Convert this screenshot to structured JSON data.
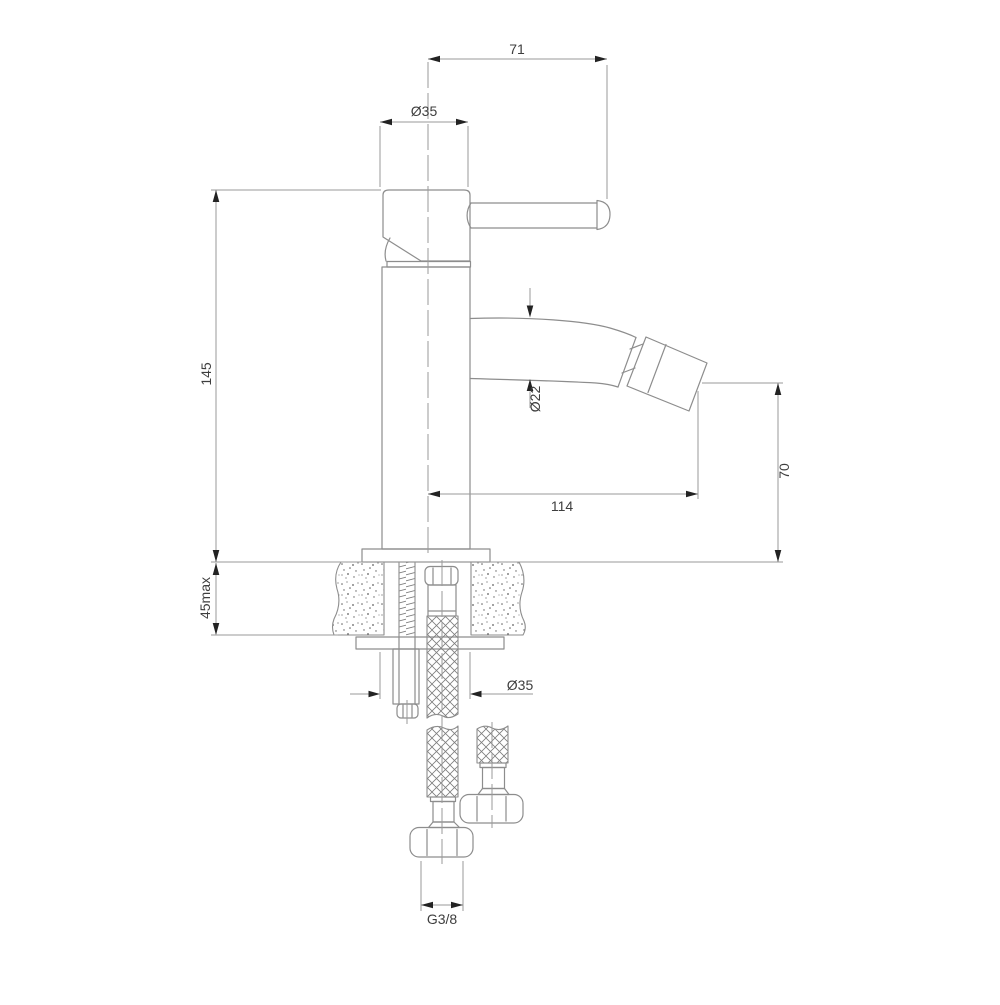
{
  "dimensions": {
    "handle_span": {
      "label": "71"
    },
    "head_diameter": {
      "label": "Ø35"
    },
    "body_height": {
      "label": "145"
    },
    "spout_diameter": {
      "label": "Ø22"
    },
    "spout_reach": {
      "label": "114"
    },
    "outlet_height": {
      "label": "70"
    },
    "deck_thickness": {
      "label": "45max"
    },
    "shank_diameter": {
      "label": "Ø35"
    },
    "connection_thread": {
      "label": "G3/8"
    }
  },
  "colors": {
    "background": "#ffffff",
    "line": "#8d8d8d",
    "dim": "#9a9a9a",
    "arrow": "#232323",
    "text": "#3e3e3e"
  }
}
